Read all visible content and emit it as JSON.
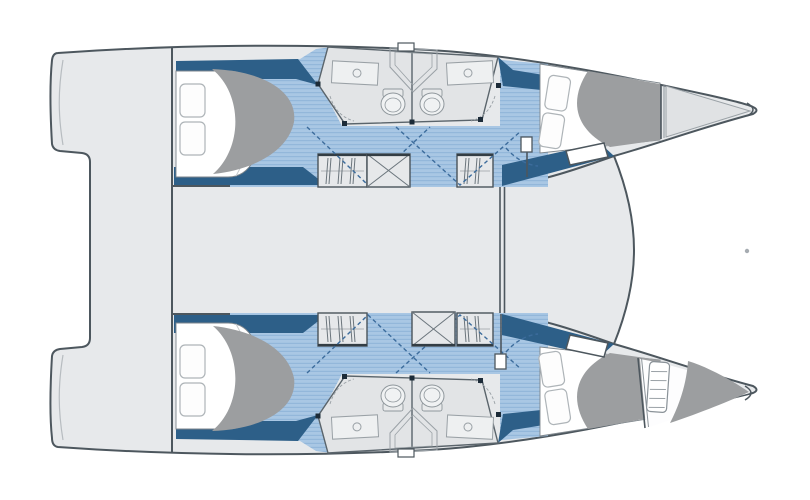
{
  "plan": {
    "title_label": "Catamaran deck plan, top view",
    "labels": {
      "plan": "Catamaran deck plan — top view",
      "port_hull": "Upper hull — aft cabin, twin en-suite heads, wardrobes, forward cabin",
      "starboard_hull": "Lower hull — aft cabin, twin en-suite heads, wardrobes, forward cabin, forepeak berth",
      "aft_cabin": "Aft double cabin with pillows and duvet",
      "forward_cabin": "Forward double cabin with pillows and duvet",
      "heads": "En-suite head with toilet, washbasin and shower",
      "wardrobe": "Hanging wardrobe locker",
      "crossed_locker": "Companionway / crossed locker box",
      "aft_platform": "Stern boarding platform",
      "aft_cockpit": "Aft cockpit deck",
      "bridgedeck": "Central bridgedeck",
      "foredeck": "Foredeck",
      "trampoline": "Trampoline opening between bows",
      "forepeak": "Forepeak skipper berth (lower bow)",
      "bow": "Bow tip",
      "mast_post": "Mast bulkhead posts and crossbeam line",
      "door_swings": "Cabin and head door swing arcs"
    },
    "inventory": {
      "double_berths": 4,
      "forepeak_berths": 1,
      "pillows": 8,
      "toilets": 4,
      "washbasins": 4,
      "wardrobe_lockers": 4,
      "crossed_locker_boxes": 2,
      "head_compartments": 4
    },
    "palette": {
      "background": "#ffffff",
      "hull_fill": "#e7e9eb",
      "deck_fill": "#e7e9eb",
      "head_floor": "#e2e4e6",
      "outline": "#4d575e",
      "accent_dark_blue": "#2d5f88",
      "floor_light_blue": "#a9c7e4",
      "floor_stripe": "#93b7da",
      "duvet_gray": "#9c9ea0",
      "fixture_line": "#9aa1a6",
      "dashed_swing": "#3c6c9c",
      "post_dark": "#1c2b38",
      "bow_triangle": "#e0e2e4"
    }
  }
}
